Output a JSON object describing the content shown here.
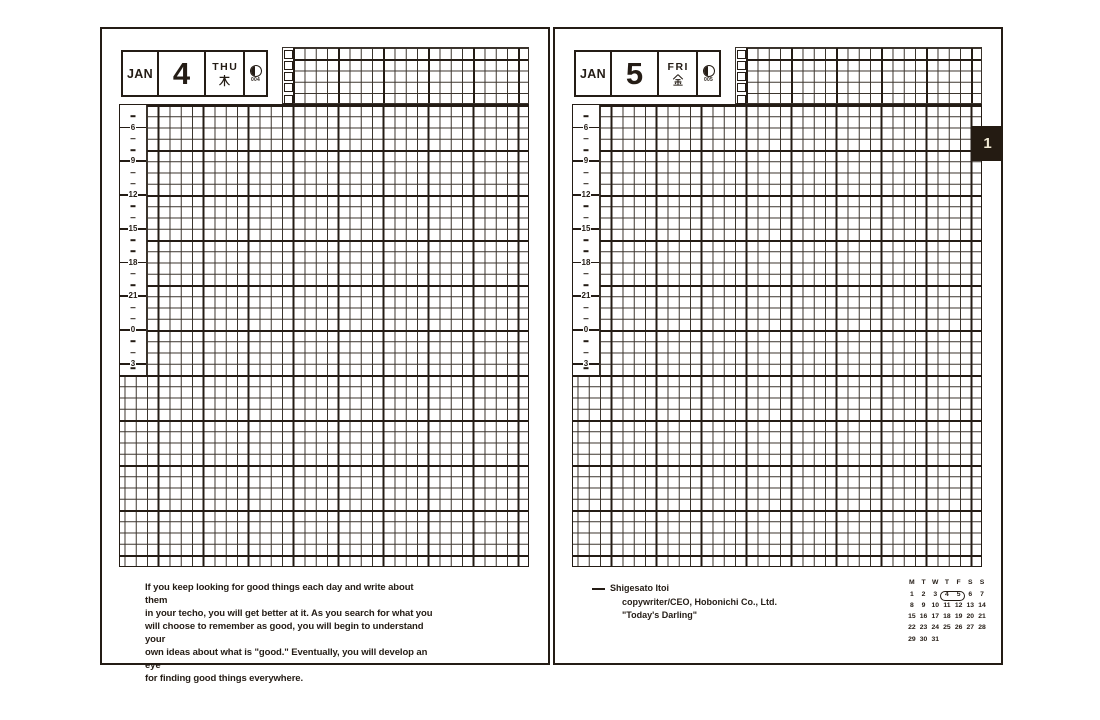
{
  "colors": {
    "ink": "#241c15",
    "grid_line": "#39322b",
    "tab_bg": "#241b12",
    "tab_text": "#f0e9d4"
  },
  "time_slots": [
    "",
    "",
    "6",
    "",
    "",
    "9",
    "",
    "",
    "12",
    "",
    "",
    "15",
    "",
    "",
    "18",
    "",
    "",
    "21",
    "",
    "",
    "0",
    "",
    "",
    "3"
  ],
  "left_page": {
    "date": {
      "month": "JAN",
      "day": "4",
      "weekday": "THU",
      "weekday_kanji": "木",
      "day_of_year": "004",
      "moon_phase": "last-quarter"
    },
    "quote_lines": [
      "If you keep looking for good things each day and write about them",
      "in your techo, you will get better at it. As you search for what you",
      "will choose to remember as good, you will begin to understand your",
      "own ideas about what is \"good.\" Eventually, you will develop an eye",
      "for finding good things everywhere."
    ]
  },
  "right_page": {
    "date": {
      "month": "JAN",
      "day": "5",
      "weekday": "FRI",
      "weekday_kanji": "金",
      "day_of_year": "005",
      "moon_phase": "last-quarter"
    },
    "attribution": {
      "name": "Shigesato Itoi",
      "role": "copywriter/CEO, Hobonichi Co., Ltd.",
      "work": "\"Today's Darling\""
    },
    "month_tab": "1",
    "mini_calendar": {
      "headers": [
        "M",
        "T",
        "W",
        "T",
        "F",
        "S",
        "S"
      ],
      "weeks": [
        [
          "1",
          "2",
          "3",
          "4",
          "5",
          "6",
          "7"
        ],
        [
          "8",
          "9",
          "10",
          "11",
          "12",
          "13",
          "14"
        ],
        [
          "15",
          "16",
          "17",
          "18",
          "19",
          "20",
          "21"
        ],
        [
          "22",
          "23",
          "24",
          "25",
          "26",
          "27",
          "28"
        ],
        [
          "29",
          "30",
          "31",
          "",
          "",
          "",
          ""
        ]
      ],
      "highlighted_days": [
        "4",
        "5"
      ]
    }
  }
}
